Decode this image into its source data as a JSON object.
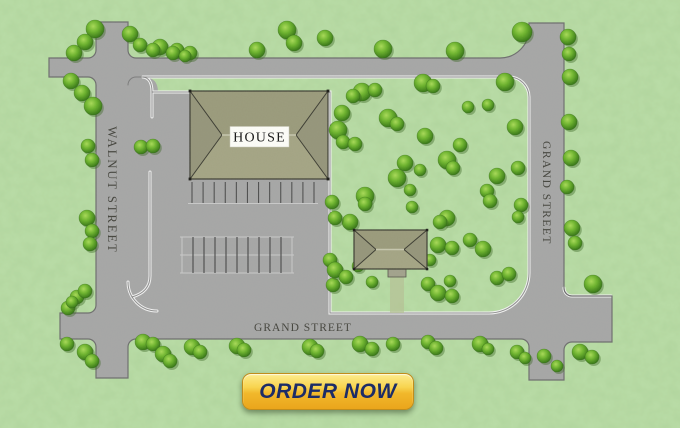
{
  "map": {
    "streets": {
      "walnut": {
        "label": "WALNUT STREET"
      },
      "grand_right": {
        "label": "GRAND STREET"
      },
      "grand_bottom": {
        "label": "GRAND STREET"
      }
    },
    "buildings": {
      "house": {
        "label": "HOUSE"
      },
      "outbuilding": {
        "label": ""
      }
    },
    "parking": {
      "row1": {
        "x0": 192,
        "x1": 314,
        "count": 12,
        "y_top": 182,
        "y_bot": 203
      },
      "row2": {
        "x0": 182,
        "x1": 292,
        "count": 11,
        "y_top": 237,
        "y_mid": 255,
        "y_bot": 273
      }
    },
    "trees": [
      [
        95,
        29,
        9
      ],
      [
        85,
        42,
        8
      ],
      [
        74,
        53,
        8
      ],
      [
        130,
        34,
        8
      ],
      [
        140,
        45,
        7
      ],
      [
        160,
        47,
        8
      ],
      [
        177,
        50,
        7
      ],
      [
        190,
        53,
        7
      ],
      [
        71,
        81,
        8
      ],
      [
        82,
        93,
        8
      ],
      [
        93,
        106,
        9
      ],
      [
        153,
        50,
        7
      ],
      [
        173,
        53,
        7
      ],
      [
        185,
        56,
        6
      ],
      [
        257,
        50,
        8
      ],
      [
        287,
        30,
        9
      ],
      [
        294,
        43,
        8
      ],
      [
        325,
        38,
        8
      ],
      [
        383,
        49,
        9
      ],
      [
        455,
        51,
        9
      ],
      [
        522,
        32,
        10
      ],
      [
        568,
        37,
        8
      ],
      [
        141,
        147,
        7
      ],
      [
        153,
        146,
        7
      ],
      [
        88,
        146,
        7
      ],
      [
        92,
        160,
        7
      ],
      [
        87,
        218,
        8
      ],
      [
        92,
        231,
        7
      ],
      [
        90,
        244,
        7
      ],
      [
        569,
        54,
        7
      ],
      [
        570,
        77,
        8
      ],
      [
        569,
        122,
        8
      ],
      [
        571,
        158,
        8
      ],
      [
        567,
        187,
        7
      ],
      [
        572,
        228,
        8
      ],
      [
        575,
        243,
        7
      ],
      [
        518,
        168,
        7
      ],
      [
        521,
        205,
        7
      ],
      [
        518,
        217,
        6
      ],
      [
        362,
        92,
        9
      ],
      [
        353,
        96,
        7
      ],
      [
        375,
        90,
        7
      ],
      [
        423,
        83,
        9
      ],
      [
        433,
        86,
        7
      ],
      [
        505,
        82,
        9
      ],
      [
        468,
        107,
        6
      ],
      [
        488,
        105,
        6
      ],
      [
        342,
        113,
        8
      ],
      [
        338,
        130,
        9
      ],
      [
        388,
        118,
        9
      ],
      [
        397,
        124,
        7
      ],
      [
        425,
        136,
        8
      ],
      [
        343,
        142,
        7
      ],
      [
        355,
        144,
        7
      ],
      [
        515,
        127,
        8
      ],
      [
        460,
        145,
        7
      ],
      [
        447,
        160,
        9
      ],
      [
        453,
        168,
        7
      ],
      [
        405,
        163,
        8
      ],
      [
        397,
        178,
        9
      ],
      [
        420,
        170,
        6
      ],
      [
        497,
        176,
        8
      ],
      [
        365,
        196,
        9
      ],
      [
        410,
        190,
        6
      ],
      [
        487,
        191,
        7
      ],
      [
        490,
        201,
        7
      ],
      [
        412,
        207,
        6
      ],
      [
        447,
        218,
        8
      ],
      [
        365,
        204,
        7
      ],
      [
        350,
        222,
        8
      ],
      [
        332,
        202,
        7
      ],
      [
        335,
        218,
        7
      ],
      [
        330,
        260,
        7
      ],
      [
        333,
        285,
        7
      ],
      [
        335,
        270,
        8
      ],
      [
        346,
        277,
        7
      ],
      [
        358,
        266,
        6
      ],
      [
        438,
        245,
        8
      ],
      [
        452,
        248,
        7
      ],
      [
        430,
        260,
        6
      ],
      [
        470,
        240,
        7
      ],
      [
        483,
        249,
        8
      ],
      [
        440,
        222,
        7
      ],
      [
        372,
        282,
        6
      ],
      [
        450,
        281,
        6
      ],
      [
        428,
        284,
        7
      ],
      [
        438,
        293,
        8
      ],
      [
        452,
        296,
        7
      ],
      [
        68,
        308,
        7
      ],
      [
        77,
        297,
        7
      ],
      [
        85,
        291,
        7
      ],
      [
        72,
        302,
        6
      ],
      [
        67,
        344,
        7
      ],
      [
        85,
        352,
        8
      ],
      [
        92,
        361,
        7
      ],
      [
        143,
        342,
        8
      ],
      [
        153,
        344,
        7
      ],
      [
        163,
        354,
        8
      ],
      [
        170,
        361,
        7
      ],
      [
        192,
        347,
        8
      ],
      [
        200,
        352,
        7
      ],
      [
        237,
        346,
        8
      ],
      [
        244,
        350,
        7
      ],
      [
        310,
        347,
        8
      ],
      [
        317,
        351,
        7
      ],
      [
        360,
        344,
        8
      ],
      [
        372,
        349,
        7
      ],
      [
        393,
        344,
        7
      ],
      [
        428,
        342,
        7
      ],
      [
        436,
        348,
        7
      ],
      [
        480,
        344,
        8
      ],
      [
        488,
        349,
        6
      ],
      [
        517,
        352,
        7
      ],
      [
        525,
        358,
        6
      ],
      [
        497,
        278,
        7
      ],
      [
        509,
        274,
        7
      ],
      [
        593,
        284,
        9
      ],
      [
        544,
        356,
        7
      ],
      [
        557,
        366,
        6
      ],
      [
        580,
        352,
        8
      ],
      [
        592,
        357,
        7
      ]
    ],
    "colors": {
      "grass": "#a8d193",
      "road": "#a6a6a6",
      "road_edge": "#6e6e6e",
      "curb": "#f2f2f2",
      "roof": "#9a9a7b",
      "roof_light": "#a4a484",
      "roof_dark": "#95957a",
      "roof_line": "#3c3c32",
      "label": "#45453e",
      "stall_dark": "#4f4f4f",
      "stall_light": "#c9c9c9",
      "path": "#b5c295",
      "cta_text": "#1c2c67"
    }
  },
  "cta": {
    "label": "ORDER NOW"
  }
}
